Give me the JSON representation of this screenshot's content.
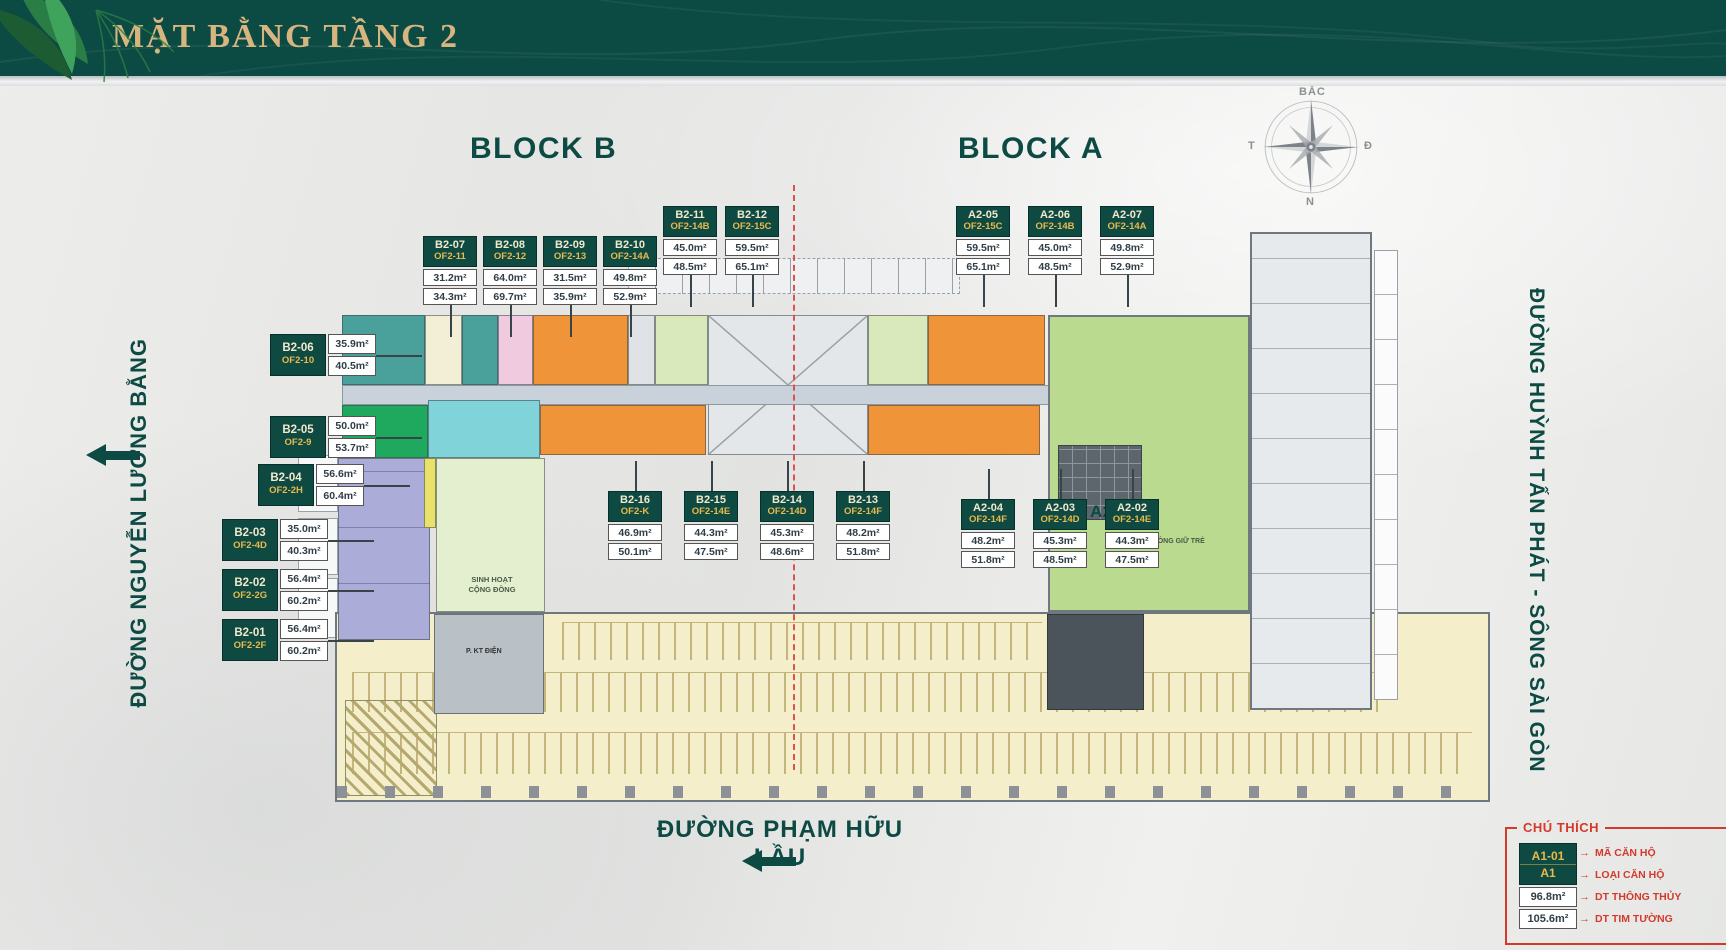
{
  "header": {
    "title": "MẶT BẰNG TẦNG 2"
  },
  "blocks": {
    "b": "BLOCK B",
    "a": "BLOCK A"
  },
  "compass": {
    "north": "BẮC",
    "west": "T",
    "east": "Đ",
    "south": "N"
  },
  "roads": {
    "left": "ĐƯỜNG NGUYỄN LƯƠNG BẰNG",
    "right": "ĐƯỜNG HUỲNH TẤN PHÁT - SÔNG SÀI GÒN",
    "bottom": "ĐƯỜNG PHẠM HỮU LẦU"
  },
  "plan_labels": {
    "a201": "A2.01",
    "childcare": "PHÒNG GIỮ TRẺ",
    "community": "SINH HOẠT CỘNG ĐỒNG",
    "technical": "P. KT ĐIỆN"
  },
  "units": [
    {
      "code": "B2-07",
      "type": "OF2-11",
      "a1": "31.2m²",
      "a2": "34.3m²",
      "style": "v",
      "lead": "down",
      "x": 423,
      "y": 236
    },
    {
      "code": "B2-08",
      "type": "OF2-12",
      "a1": "64.0m²",
      "a2": "69.7m²",
      "style": "v",
      "lead": "down",
      "x": 483,
      "y": 236
    },
    {
      "code": "B2-09",
      "type": "OF2-13",
      "a1": "31.5m²",
      "a2": "35.9m²",
      "style": "v",
      "lead": "down",
      "x": 543,
      "y": 236
    },
    {
      "code": "B2-10",
      "type": "OF2-14A",
      "a1": "49.8m²",
      "a2": "52.9m²",
      "style": "v",
      "lead": "down",
      "x": 603,
      "y": 236
    },
    {
      "code": "B2-11",
      "type": "OF2-14B",
      "a1": "45.0m²",
      "a2": "48.5m²",
      "style": "v",
      "lead": "down",
      "x": 663,
      "y": 206
    },
    {
      "code": "B2-12",
      "type": "OF2-15C",
      "a1": "59.5m²",
      "a2": "65.1m²",
      "style": "v",
      "lead": "down",
      "x": 725,
      "y": 206
    },
    {
      "code": "A2-05",
      "type": "OF2-15C",
      "a1": "59.5m²",
      "a2": "65.1m²",
      "style": "v",
      "lead": "down",
      "x": 956,
      "y": 206
    },
    {
      "code": "A2-06",
      "type": "OF2-14B",
      "a1": "45.0m²",
      "a2": "48.5m²",
      "style": "v",
      "lead": "down",
      "x": 1028,
      "y": 206
    },
    {
      "code": "A2-07",
      "type": "OF2-14A",
      "a1": "49.8m²",
      "a2": "52.9m²",
      "style": "v",
      "lead": "down",
      "x": 1100,
      "y": 206
    },
    {
      "code": "B2-06",
      "type": "OF2-10",
      "a1": "35.9m²",
      "a2": "40.5m²",
      "style": "h",
      "lead": "right",
      "x": 270,
      "y": 334
    },
    {
      "code": "B2-05",
      "type": "OF2-9",
      "a1": "50.0m²",
      "a2": "53.7m²",
      "style": "h",
      "lead": "right",
      "x": 270,
      "y": 416
    },
    {
      "code": "B2-04",
      "type": "OF2-2H",
      "a1": "56.6m²",
      "a2": "60.4m²",
      "style": "h",
      "lead": "right",
      "x": 258,
      "y": 464
    },
    {
      "code": "B2-03",
      "type": "OF2-4D",
      "a1": "35.0m²",
      "a2": "40.3m²",
      "style": "h",
      "lead": "right",
      "x": 222,
      "y": 519
    },
    {
      "code": "B2-02",
      "type": "OF2-2G",
      "a1": "56.4m²",
      "a2": "60.2m²",
      "style": "h",
      "lead": "right",
      "x": 222,
      "y": 569
    },
    {
      "code": "B2-01",
      "type": "OF2-2F",
      "a1": "56.4m²",
      "a2": "60.2m²",
      "style": "h",
      "lead": "right",
      "x": 222,
      "y": 619
    },
    {
      "code": "B2-16",
      "type": "OF2-K",
      "a1": "46.9m²",
      "a2": "50.1m²",
      "style": "v",
      "lead": "up",
      "x": 608,
      "y": 491
    },
    {
      "code": "B2-15",
      "type": "OF2-14E",
      "a1": "44.3m²",
      "a2": "47.5m²",
      "style": "v",
      "lead": "up",
      "x": 684,
      "y": 491
    },
    {
      "code": "B2-14",
      "type": "OF2-14D",
      "a1": "45.3m²",
      "a2": "48.6m²",
      "style": "v",
      "lead": "up",
      "x": 760,
      "y": 491
    },
    {
      "code": "B2-13",
      "type": "OF2-14F",
      "a1": "48.2m²",
      "a2": "51.8m²",
      "style": "v",
      "lead": "up",
      "x": 836,
      "y": 491
    },
    {
      "code": "A2-04",
      "type": "OF2-14F",
      "a1": "48.2m²",
      "a2": "51.8m²",
      "style": "v",
      "lead": "up",
      "x": 961,
      "y": 499
    },
    {
      "code": "A2-03",
      "type": "OF2-14D",
      "a1": "45.3m²",
      "a2": "48.5m²",
      "style": "v",
      "lead": "up",
      "x": 1033,
      "y": 499
    },
    {
      "code": "A2-02",
      "type": "OF2-14E",
      "a1": "44.3m²",
      "a2": "47.5m²",
      "style": "v",
      "lead": "up",
      "x": 1105,
      "y": 499
    }
  ],
  "legend": {
    "title": "CHÚ THÍCH",
    "sample_code": "A1-01",
    "sample_type": "A1",
    "sample_area1": "96.8m²",
    "sample_area2": "105.6m²",
    "arrow": "→",
    "labels": {
      "code": "MÃ CĂN HỘ",
      "type": "LOẠI CĂN HỘ",
      "area1": "DT THÔNG THỦY",
      "area2": "DT TIM TƯỜNG"
    }
  },
  "colors": {
    "header_bg": "#0c4a44",
    "gold": "#d7b57e",
    "teal": "#0d4a44",
    "label_teal": "#0f4a42",
    "code_cream": "#f2e9cd",
    "type_gold": "#e7b94e",
    "red": "#d23a2c",
    "orange": "#f0943a",
    "green_area": "#bada90",
    "green_bright": "#1fa95e",
    "lavender": "#abadd8",
    "cyan": "#80d3d8",
    "pink": "#f0cade",
    "parking": "#f4eeca",
    "corridor": "#c9d2da",
    "dash_red": "#e05050"
  }
}
